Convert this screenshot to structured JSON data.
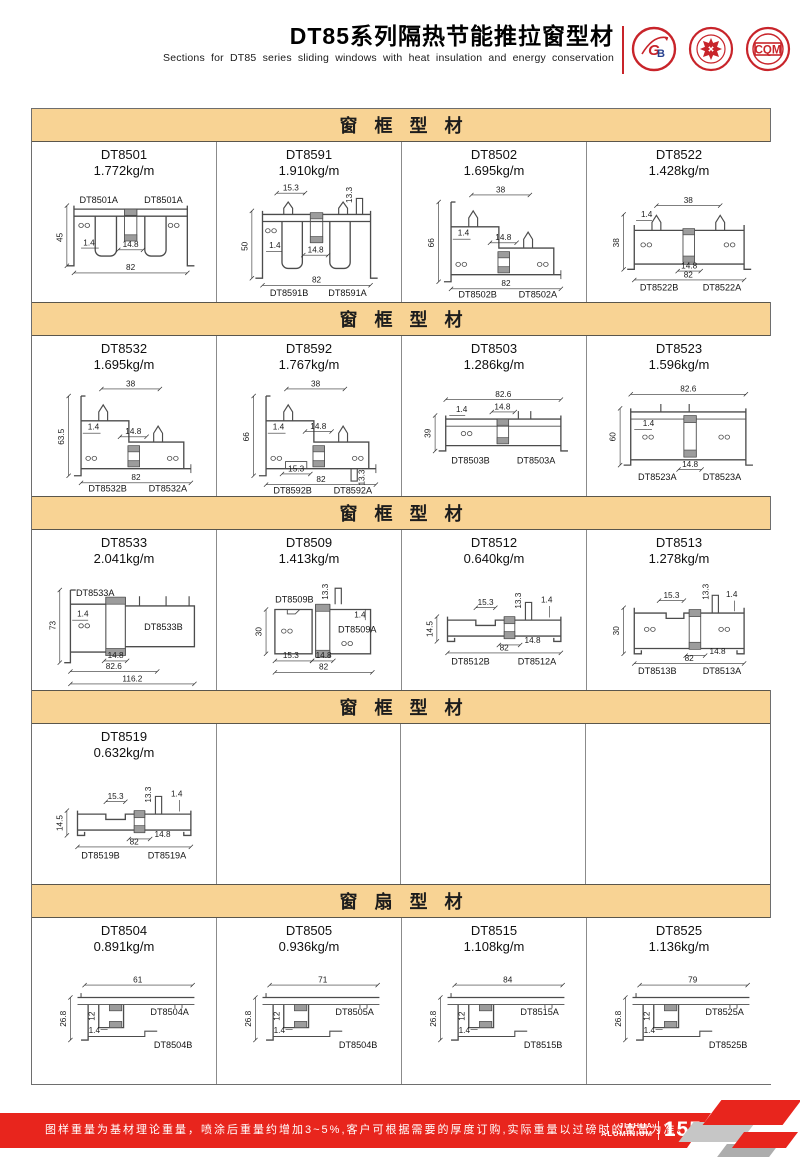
{
  "header": {
    "title": "DT85系列隔热节能推拉窗型材",
    "subtitle": "Sections for DT85 series sliding windows with heat insulation and energy conservation",
    "logos": [
      {
        "name": "gb-cert-logo",
        "text": "GB"
      },
      {
        "name": "flower-cert-logo",
        "text": ""
      },
      {
        "name": "cqm-cert-logo",
        "text": "CQM"
      }
    ]
  },
  "sections": [
    {
      "title": "窗框型材",
      "cells": [
        {
          "code": "DT8501",
          "weight": "1.772kg/m",
          "variant": "symLow",
          "labels": [
            {
              "text": "DT8501A",
              "slot": "tl"
            },
            {
              "text": "DT8501A",
              "slot": "tr"
            }
          ],
          "dims": [
            {
              "text": "45",
              "slot": "height"
            },
            {
              "text": "1.4",
              "slot": "thickness"
            },
            {
              "text": "14.8",
              "slot": "midwidth"
            },
            {
              "text": "82",
              "slot": "width"
            }
          ]
        },
        {
          "code": "DT8591",
          "weight": "1.910kg/m",
          "variant": "symTall",
          "labels": [
            {
              "text": "DT8591B",
              "slot": "bl"
            },
            {
              "text": "DT8591A",
              "slot": "br"
            }
          ],
          "dims": [
            {
              "text": "15.3",
              "slot": "notch"
            },
            {
              "text": "13.3",
              "slot": "pin"
            },
            {
              "text": "50",
              "slot": "height"
            },
            {
              "text": "1.4",
              "slot": "thickness"
            },
            {
              "text": "14.8",
              "slot": "midwidth"
            },
            {
              "text": "82",
              "slot": "width"
            }
          ]
        },
        {
          "code": "DT8502",
          "weight": "1.695kg/m",
          "variant": "step",
          "labels": [
            {
              "text": "DT8502B",
              "slot": "bl"
            },
            {
              "text": "DT8502A",
              "slot": "br"
            }
          ],
          "dims": [
            {
              "text": "38",
              "slot": "topwidth"
            },
            {
              "text": "66",
              "slot": "height"
            },
            {
              "text": "1.4",
              "slot": "thickness"
            },
            {
              "text": "14.8",
              "slot": "midwidth"
            },
            {
              "text": "82",
              "slot": "width"
            }
          ]
        },
        {
          "code": "DT8522",
          "weight": "1.428kg/m",
          "variant": "lowHooks",
          "labels": [
            {
              "text": "DT8522B",
              "slot": "bl"
            },
            {
              "text": "DT8522A",
              "slot": "br"
            }
          ],
          "dims": [
            {
              "text": "38",
              "slot": "topwidth"
            },
            {
              "text": "1.4",
              "slot": "thickness"
            },
            {
              "text": "38",
              "slot": "height"
            },
            {
              "text": "14.8",
              "slot": "midwidth"
            },
            {
              "text": "82",
              "slot": "width"
            }
          ]
        }
      ]
    },
    {
      "title": "窗框型材",
      "cells": [
        {
          "code": "DT8532",
          "weight": "1.695kg/m",
          "variant": "step",
          "labels": [
            {
              "text": "DT8532B",
              "slot": "bl"
            },
            {
              "text": "DT8532A",
              "slot": "br"
            }
          ],
          "dims": [
            {
              "text": "38",
              "slot": "topwidth"
            },
            {
              "text": "63.5",
              "slot": "height"
            },
            {
              "text": "1.4",
              "slot": "thickness"
            },
            {
              "text": "14.8",
              "slot": "midwidth"
            },
            {
              "text": "82",
              "slot": "width"
            }
          ]
        },
        {
          "code": "DT8592",
          "weight": "1.767kg/m",
          "variant": "step2",
          "labels": [
            {
              "text": "DT8592B",
              "slot": "bl"
            },
            {
              "text": "DT8592A",
              "slot": "br"
            }
          ],
          "dims": [
            {
              "text": "38",
              "slot": "topwidth"
            },
            {
              "text": "66",
              "slot": "height"
            },
            {
              "text": "1.4",
              "slot": "thickness"
            },
            {
              "text": "14.8",
              "slot": "midwidth"
            },
            {
              "text": "15.3",
              "slot": "notch"
            },
            {
              "text": "82",
              "slot": "width"
            },
            {
              "text": "13.3",
              "slot": "pin"
            }
          ]
        },
        {
          "code": "DT8503",
          "weight": "1.286kg/m",
          "variant": "flat",
          "labels": [
            {
              "text": "DT8503B",
              "slot": "bl"
            },
            {
              "text": "DT8503A",
              "slot": "br"
            }
          ],
          "dims": [
            {
              "text": "82.6",
              "slot": "topwidth"
            },
            {
              "text": "1.4",
              "slot": "thickness"
            },
            {
              "text": "14.8",
              "slot": "midwidth"
            },
            {
              "text": "39",
              "slot": "height"
            }
          ]
        },
        {
          "code": "DT8523",
          "weight": "1.596kg/m",
          "variant": "midtall",
          "labels": [
            {
              "text": "DT8523A",
              "slot": "bl"
            },
            {
              "text": "DT8523A",
              "slot": "br"
            }
          ],
          "dims": [
            {
              "text": "82.6",
              "slot": "topwidth"
            },
            {
              "text": "60",
              "slot": "height"
            },
            {
              "text": "1.4",
              "slot": "thickness"
            },
            {
              "text": "14.8",
              "slot": "midwidth"
            }
          ]
        }
      ]
    },
    {
      "title": "窗框型材",
      "cells": [
        {
          "code": "DT8533",
          "weight": "2.041kg/m",
          "variant": "wide",
          "labels": [
            {
              "text": "DT8533A",
              "slot": "tl"
            },
            {
              "text": "DT8533B",
              "slot": "mid"
            }
          ],
          "dims": [
            {
              "text": "73",
              "slot": "height"
            },
            {
              "text": "1.4",
              "slot": "thickness"
            },
            {
              "text": "14.8",
              "slot": "midwidth"
            },
            {
              "text": "82.6",
              "slot": "width"
            },
            {
              "text": "116.2",
              "slot": "width2"
            }
          ]
        },
        {
          "code": "DT8509",
          "weight": "1.413kg/m",
          "variant": "boxpair",
          "labels": [
            {
              "text": "DT8509B",
              "slot": "top"
            },
            {
              "text": "DT8509A",
              "slot": "right"
            }
          ],
          "dims": [
            {
              "text": "30",
              "slot": "height"
            },
            {
              "text": "13.3",
              "slot": "pin"
            },
            {
              "text": "1.4",
              "slot": "thickness"
            },
            {
              "text": "15.3",
              "slot": "notch"
            },
            {
              "text": "14.8",
              "slot": "midwidth"
            },
            {
              "text": "82",
              "slot": "width"
            }
          ]
        },
        {
          "code": "DT8512",
          "weight": "0.640kg/m",
          "variant": "lowflat",
          "labels": [
            {
              "text": "DT8512B",
              "slot": "bl"
            },
            {
              "text": "DT8512A",
              "slot": "br"
            }
          ],
          "dims": [
            {
              "text": "15.3",
              "slot": "notch"
            },
            {
              "text": "13.3",
              "slot": "pin"
            },
            {
              "text": "1.4",
              "slot": "thickness"
            },
            {
              "text": "14.5",
              "slot": "height"
            },
            {
              "text": "14.8",
              "slot": "midwidth"
            },
            {
              "text": "82",
              "slot": "width"
            }
          ]
        },
        {
          "code": "DT8513",
          "weight": "1.278kg/m",
          "variant": "midflat",
          "labels": [
            {
              "text": "DT8513B",
              "slot": "bl"
            },
            {
              "text": "DT8513A",
              "slot": "br"
            }
          ],
          "dims": [
            {
              "text": "15.3",
              "slot": "notch"
            },
            {
              "text": "13.3",
              "slot": "pin"
            },
            {
              "text": "1.4",
              "slot": "thickness"
            },
            {
              "text": "30",
              "slot": "height"
            },
            {
              "text": "14.8",
              "slot": "midwidth"
            },
            {
              "text": "82",
              "slot": "width"
            }
          ]
        }
      ]
    },
    {
      "title": "窗框型材",
      "cells": [
        {
          "code": "DT8519",
          "weight": "0.632kg/m",
          "variant": "lowflat",
          "labels": [
            {
              "text": "DT8519B",
              "slot": "bl"
            },
            {
              "text": "DT8519A",
              "slot": "br"
            }
          ],
          "dims": [
            {
              "text": "15.3",
              "slot": "notch"
            },
            {
              "text": "13.3",
              "slot": "pin"
            },
            {
              "text": "1.4",
              "slot": "thickness"
            },
            {
              "text": "14.5",
              "slot": "height"
            },
            {
              "text": "14.8",
              "slot": "midwidth"
            },
            {
              "text": "82",
              "slot": "width"
            }
          ]
        },
        null,
        null,
        null
      ]
    },
    {
      "title": "窗扇型材",
      "cells": [
        {
          "code": "DT8504",
          "weight": "0.891kg/m",
          "variant": "sash",
          "labels": [
            {
              "text": "DT8504A",
              "slot": "rightA"
            },
            {
              "text": "DT8504B",
              "slot": "rightB"
            }
          ],
          "dims": [
            {
              "text": "61",
              "slot": "topwidth"
            },
            {
              "text": "26.8",
              "slot": "height"
            },
            {
              "text": "12",
              "slot": "v12"
            },
            {
              "text": "1.4",
              "slot": "thickness"
            }
          ]
        },
        {
          "code": "DT8505",
          "weight": "0.936kg/m",
          "variant": "sash",
          "labels": [
            {
              "text": "DT8505A",
              "slot": "rightA"
            },
            {
              "text": "DT8504B",
              "slot": "rightB"
            }
          ],
          "dims": [
            {
              "text": "71",
              "slot": "topwidth"
            },
            {
              "text": "26.8",
              "slot": "height"
            },
            {
              "text": "12",
              "slot": "v12"
            },
            {
              "text": "1.4",
              "slot": "thickness"
            }
          ]
        },
        {
          "code": "DT8515",
          "weight": "1.108kg/m",
          "variant": "sash",
          "labels": [
            {
              "text": "DT8515A",
              "slot": "rightA"
            },
            {
              "text": "DT8515B",
              "slot": "rightB"
            }
          ],
          "dims": [
            {
              "text": "84",
              "slot": "topwidth"
            },
            {
              "text": "26.8",
              "slot": "height"
            },
            {
              "text": "12",
              "slot": "v12"
            },
            {
              "text": "1.4",
              "slot": "thickness"
            }
          ]
        },
        {
          "code": "DT8525",
          "weight": "1.136kg/m",
          "variant": "sash",
          "labels": [
            {
              "text": "DT8525A",
              "slot": "rightA"
            },
            {
              "text": "DT8525B",
              "slot": "rightB"
            }
          ],
          "dims": [
            {
              "text": "79",
              "slot": "topwidth"
            },
            {
              "text": "26.8",
              "slot": "height"
            },
            {
              "text": "12",
              "slot": "v12"
            },
            {
              "text": "1.4",
              "slot": "thickness"
            }
          ]
        }
      ]
    }
  ],
  "footer": {
    "note": "图样重量为基材理论重量，喷涂后重量约增加3~5%,客户可根据需要的厚度订购,实际重量以过磅时的重量为准。",
    "brand_line1": "JIAHUA",
    "brand_line2": "ALUMINIUM",
    "page": "155"
  },
  "colors": {
    "band_bg": "#F8D394",
    "accent_red": "#E8251D",
    "logo_red": "#C8242A"
  }
}
